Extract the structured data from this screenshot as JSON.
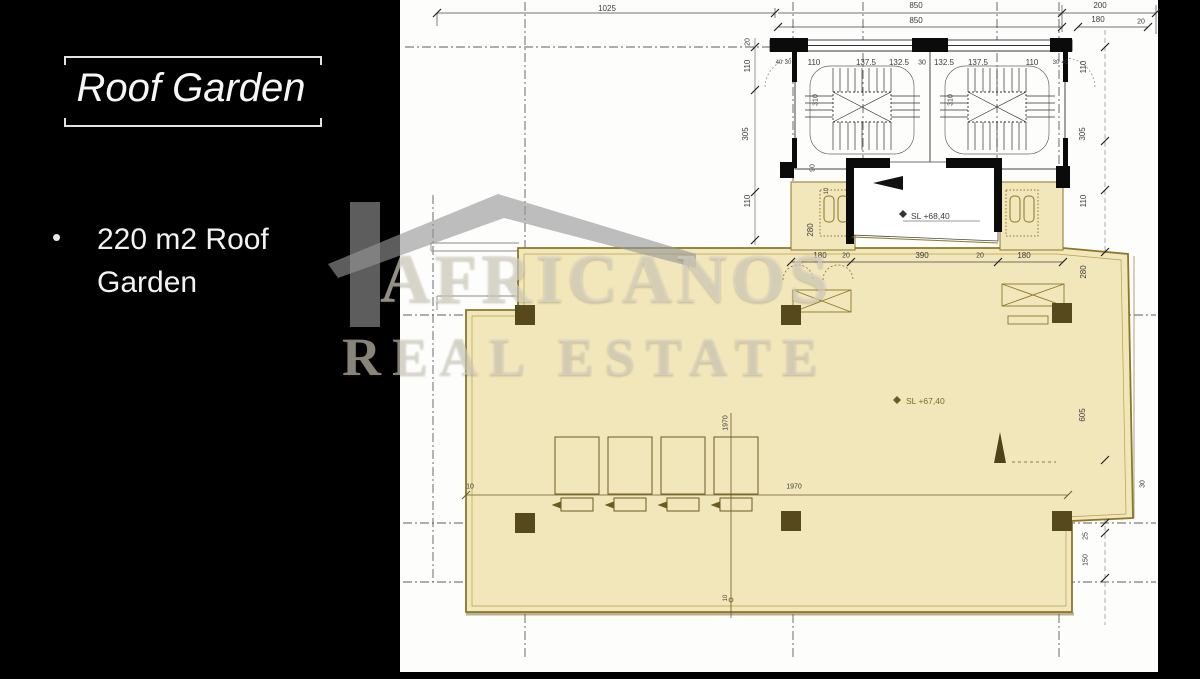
{
  "slide": {
    "title": "Roof Garden",
    "bullet": "220 m2 Roof Garden"
  },
  "watermark": {
    "line1": "AFRICANOS",
    "line2": "REAL ESTATE",
    "icon": "house-logo"
  },
  "plan": {
    "levels": {
      "machine_room": "SL +68,40",
      "roof_garden": "SL +67,40"
    },
    "colors": {
      "highlight": "#f2e6bb",
      "highlight_border": "#8a7827",
      "column": "#564a1c",
      "paper": "#fdfdfc",
      "page_background": "#000000",
      "drawing_line": "#3c3c3c"
    },
    "labels": [
      {
        "t": "1025",
        "x": 607,
        "y": 9
      },
      {
        "t": "850",
        "x": 916,
        "y": 6
      },
      {
        "t": "850",
        "x": 916,
        "y": 21
      },
      {
        "t": "200",
        "x": 1100,
        "y": 6
      },
      {
        "t": "180",
        "x": 1098,
        "y": 20
      },
      {
        "t": "20",
        "x": 1141,
        "y": 22,
        "s": 7
      },
      {
        "t": "110",
        "x": 814,
        "y": 63
      },
      {
        "t": "137.5",
        "x": 866,
        "y": 63
      },
      {
        "t": "132.5",
        "x": 899,
        "y": 63
      },
      {
        "t": "30",
        "x": 922,
        "y": 63,
        "s": 7
      },
      {
        "t": "132.5",
        "x": 944,
        "y": 63
      },
      {
        "t": "137.5",
        "x": 978,
        "y": 63
      },
      {
        "t": "110",
        "x": 1032,
        "y": 63
      },
      {
        "t": "40",
        "x": 779,
        "y": 63,
        "s": 6
      },
      {
        "t": "30",
        "x": 788,
        "y": 63,
        "s": 6
      },
      {
        "t": "30",
        "x": 1056,
        "y": 63,
        "s": 6
      },
      {
        "t": "40",
        "x": 1065,
        "y": 63,
        "s": 6
      },
      {
        "t": "310",
        "x": 816,
        "y": 100,
        "r": 1,
        "s": 7
      },
      {
        "t": "310",
        "x": 951,
        "y": 100,
        "r": 1,
        "s": 7
      },
      {
        "t": "20",
        "x": 748,
        "y": 42,
        "r": 1,
        "s": 7
      },
      {
        "t": "110",
        "x": 748,
        "y": 66,
        "r": 1
      },
      {
        "t": "305",
        "x": 746,
        "y": 134,
        "r": 1
      },
      {
        "t": "110",
        "x": 748,
        "y": 201,
        "r": 1
      },
      {
        "t": "110",
        "x": 1084,
        "y": 67,
        "r": 1
      },
      {
        "t": "305",
        "x": 1083,
        "y": 134,
        "r": 1
      },
      {
        "t": "110",
        "x": 1084,
        "y": 201,
        "r": 1
      },
      {
        "t": "280",
        "x": 1084,
        "y": 272,
        "r": 1
      },
      {
        "t": "605",
        "x": 1083,
        "y": 415,
        "r": 1
      },
      {
        "t": "30",
        "x": 1143,
        "y": 484,
        "r": 1,
        "s": 7
      },
      {
        "t": "25",
        "x": 1086,
        "y": 536,
        "r": 1,
        "s": 7
      },
      {
        "t": "150",
        "x": 1086,
        "y": 560,
        "r": 1,
        "s": 7
      },
      {
        "t": "90",
        "x": 813,
        "y": 168,
        "r": 1,
        "s": 7
      },
      {
        "t": "10",
        "x": 827,
        "y": 191,
        "r": 1,
        "s": 6
      },
      {
        "t": "280",
        "x": 811,
        "y": 230,
        "r": 1
      },
      {
        "t": "180",
        "x": 820,
        "y": 256
      },
      {
        "t": "20",
        "x": 846,
        "y": 256,
        "s": 7
      },
      {
        "t": "390",
        "x": 922,
        "y": 256
      },
      {
        "t": "20",
        "x": 980,
        "y": 256,
        "s": 7
      },
      {
        "t": "180",
        "x": 1024,
        "y": 256
      },
      {
        "t": "1970",
        "x": 726,
        "y": 423,
        "r": 1,
        "s": 7
      },
      {
        "t": "10",
        "x": 470,
        "y": 487,
        "s": 7
      },
      {
        "t": "1970",
        "x": 794,
        "y": 487,
        "s": 7
      },
      {
        "t": "10",
        "x": 726,
        "y": 598,
        "r": 1,
        "s": 6
      }
    ]
  }
}
